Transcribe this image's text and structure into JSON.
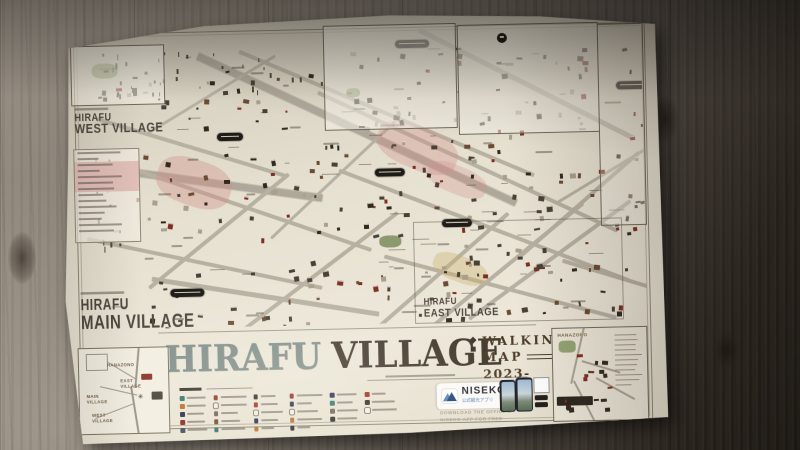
{
  "poster": {
    "title": {
      "part1": "HIRAFU",
      "part2": "VILLAGE"
    },
    "subtitle": {
      "line1": "WALKING",
      "line2": "MAP",
      "line3": "2023-2024"
    },
    "regions": {
      "west": {
        "line1": "HIRAFU",
        "line2": "WEST VILLAGE"
      },
      "main": {
        "line1": "HIRAFU",
        "line2": "MAIN VILLAGE"
      },
      "east": {
        "line1": "HIRAFU",
        "line2": "EAST VILLAGE"
      }
    },
    "hanazono_inset": {
      "label": "HANAZONO"
    },
    "overview_inset": {
      "labels": [
        "HANAZONO",
        "EAST\nVILLAGE",
        "MAIN\nVILLAGE",
        "WEST\nVILLAGE"
      ]
    },
    "app_block": {
      "brand": "NISEKO",
      "brand_sub": "公式観光アプリ",
      "download_line1": "DOWNLOAD THE OFFICIAL",
      "download_line2": "NISEKO APP FOR FREE"
    },
    "colors": {
      "paper": "#e9e4d5",
      "title_hirafu": "#818f8c",
      "title_village": "#433a2e",
      "subtitle_brown": "#4e3c2b",
      "road_gray": "#b7b1a2",
      "pink_zone": "#d99a96",
      "green_zone": "#7f9160",
      "label_dark": "#4c463d"
    },
    "legend": {
      "columns": [
        [
          "#37756d",
          "#bc6d2c",
          "#27324e",
          "#8e2b1f",
          "#44505f"
        ],
        [
          "#a03224",
          "#f2eee3",
          "#6d675c",
          "#7a4a2a",
          "#37756d"
        ],
        [
          "#332e27",
          "#a03224",
          "#f2eee3",
          "#27324e",
          "#bc6d2c"
        ],
        [
          "#8e2b1f",
          "#27324e",
          "#f2eee3",
          "#bc6d2c",
          "#332e27"
        ],
        [
          "#27324e",
          "#37756d",
          "#6d675c",
          "#332e27"
        ],
        [
          "#a03224",
          "#332e27",
          "#f2eee3"
        ]
      ]
    }
  }
}
